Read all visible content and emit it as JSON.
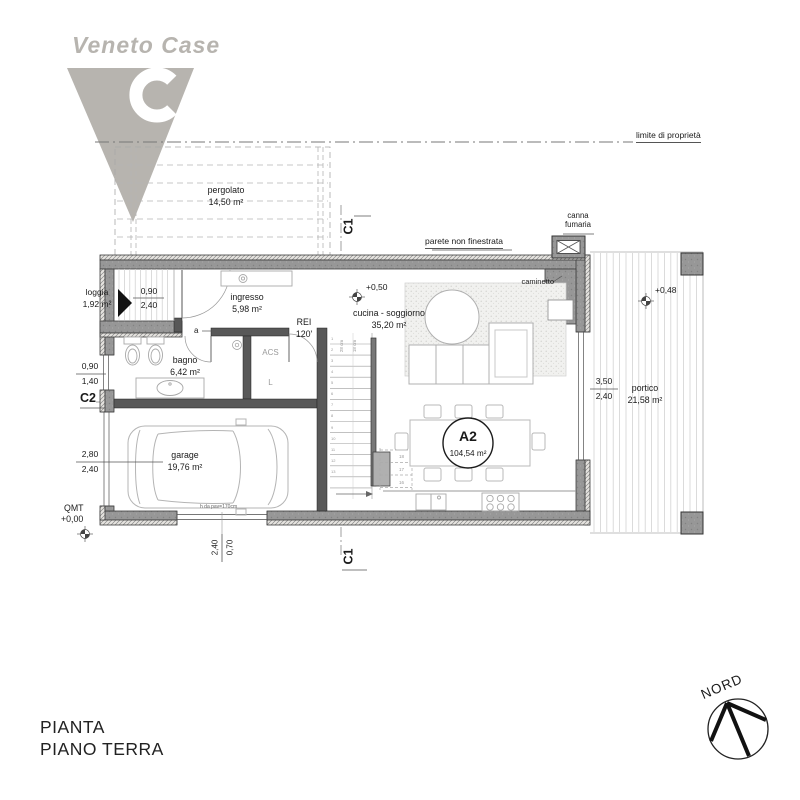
{
  "logo": {
    "brand": "Veneto Case"
  },
  "site": {
    "property_line_label": "limite di proprietà",
    "pergolato": {
      "name": "pergolato",
      "area": "14,50 m²"
    }
  },
  "sections": {
    "c1_top": "C1",
    "c1_bottom": "C1",
    "c2": "C2"
  },
  "notes": {
    "parete": "parete non finestrata",
    "canna_line1": "canna",
    "canna_line2": "fumaria",
    "caminetto": "caminetto",
    "rei_line1": "REI",
    "rei_line2": "120'",
    "door_a": "a",
    "acs": "ACS",
    "laundry": "L",
    "window_note": "h da pav=170cm"
  },
  "rooms": {
    "loggia": {
      "name": "loggia",
      "area": "1,92 m²"
    },
    "ingresso": {
      "name": "ingresso",
      "area": "5,98 m²"
    },
    "bagno": {
      "name": "bagno",
      "area": "6,42 m²"
    },
    "cucina": {
      "name": "cucina - soggiorno",
      "area": "35,20 m²"
    },
    "garage": {
      "name": "garage",
      "area": "19,76 m²"
    },
    "portico": {
      "name": "portico",
      "area": "21,58 m²"
    }
  },
  "unit": {
    "code": "A2",
    "area": "104,54 m²"
  },
  "levels": {
    "living": "+0,50",
    "portico": "+0,48",
    "qmt_label": "QMT",
    "qmt_value": "+0,00"
  },
  "dims": {
    "entrance_w": "0,90",
    "entrance_h": "2,40",
    "bath_w": "0,90",
    "bath_h": "1,40",
    "garage_w": "2,80",
    "garage_h": "2,40",
    "portico_w": "3,50",
    "portico_h": "2,40",
    "gwin_w": "2,40",
    "gwin_h": "0,70"
  },
  "stairs": {
    "numbers": [
      "1",
      "2",
      "3",
      "4",
      "5",
      "6",
      "7",
      "8",
      "9",
      "10",
      "11",
      "12",
      "13"
    ],
    "n16": "16",
    "n17": "17",
    "n18": "18",
    "note1": "28 cm",
    "note2": "18 cm"
  },
  "titleblock": {
    "line1": "PIANTA",
    "line2": "PIANO TERRA"
  },
  "compass": {
    "north": "NORD"
  }
}
